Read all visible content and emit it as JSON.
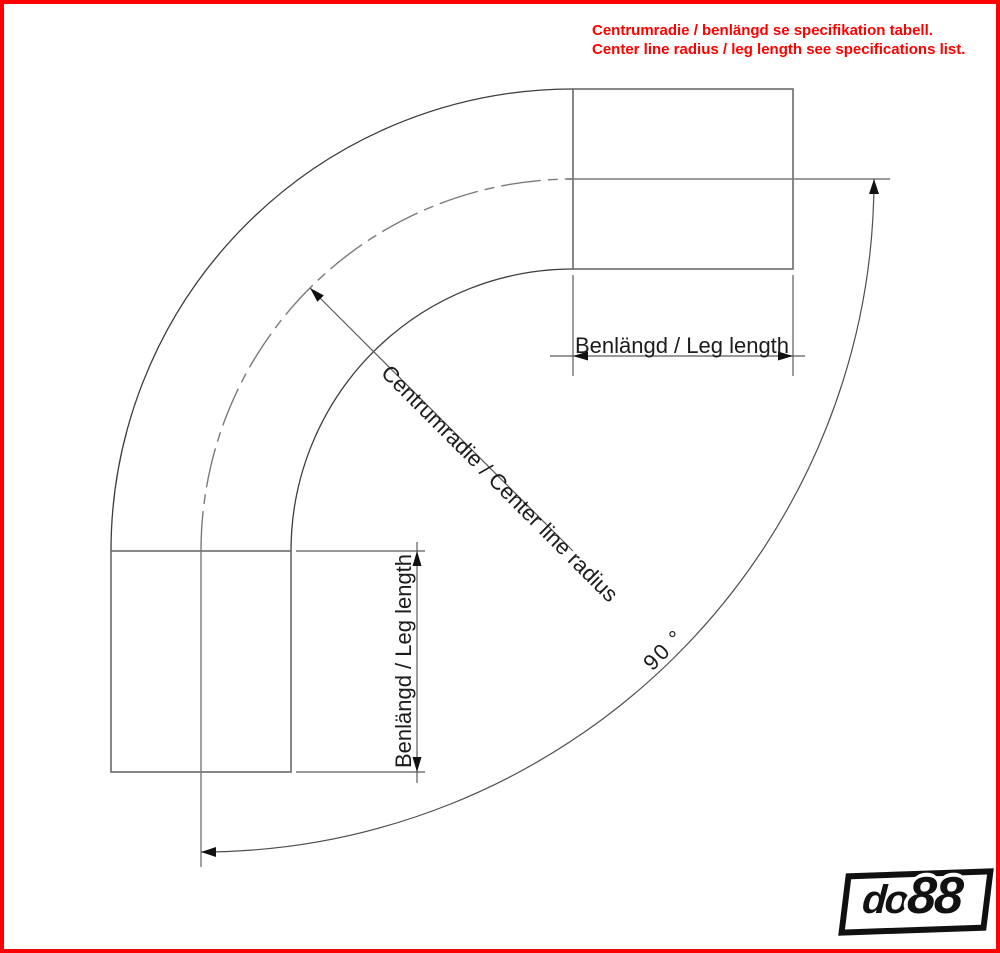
{
  "note": {
    "line1": "Centrumradie / benlängd se specifikation tabell.",
    "line2": "Center line radius / leg length see specifications list."
  },
  "labels": {
    "leg_length_top": "Benlängd / Leg length",
    "leg_length_left": "Benlängd / Leg length",
    "center_line_radius": "Centrumradie / Center line radius",
    "bend_angle": "90 °"
  },
  "diagram": {
    "description": "Technical drawing of a 90 degree pipe bend with two straight legs",
    "bend_angle_deg": 90
  },
  "logo": {
    "do": "do",
    "eights": "88"
  },
  "colors": {
    "border": "#ff0000",
    "note_text": "#ff0000",
    "arc_line": "#3d3d3d",
    "outline_line": "#6b6b6b",
    "center_line": "#7a7a7a",
    "dimension_line": "#5c5c5c",
    "arrow_fill": "#111111",
    "label_text": "#1c1c1c"
  }
}
